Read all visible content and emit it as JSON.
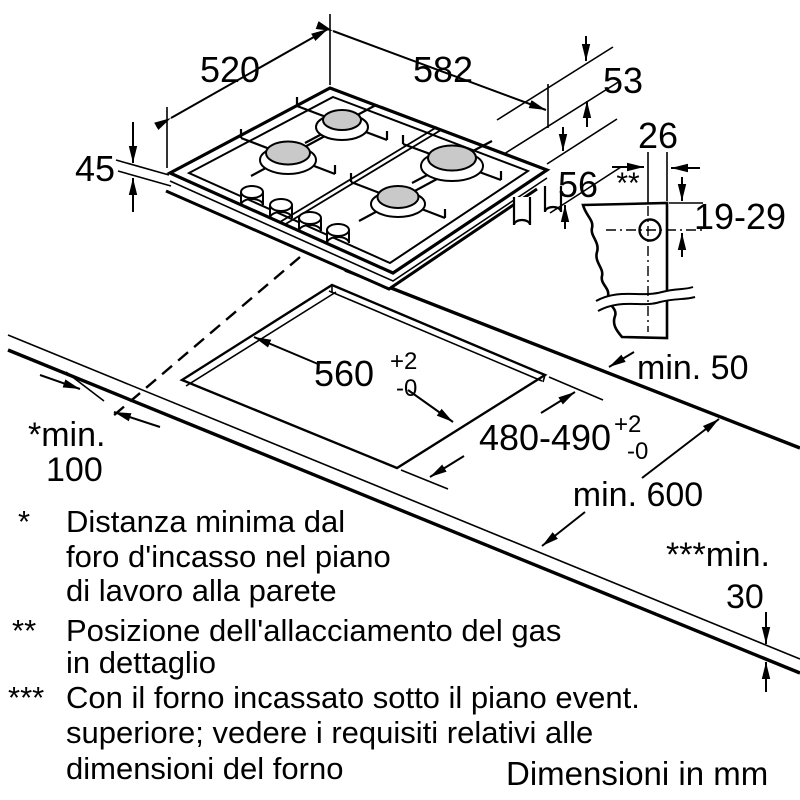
{
  "hob": {
    "width": "582",
    "depth": "520",
    "height_left": "45",
    "height_top_right": "53",
    "height_right": "56"
  },
  "gas_detail": {
    "marker": "**",
    "offset_from_edge": "26",
    "height_range": "19-29"
  },
  "cutout": {
    "width": "560",
    "depth": "480-490",
    "tol_plus": "+2",
    "tol_minus": "-0",
    "rear_clearance": "min. 50",
    "worktop_depth": "min. 600",
    "wall_clearance_line1": "*min.",
    "wall_clearance_line2": "100",
    "thickness_line1": "***min.",
    "thickness_line2": "30"
  },
  "footnotes": [
    {
      "marker": "*",
      "lines": [
        "Distanza minima dal",
        "foro d'incasso nel piano",
        "di lavoro alla parete"
      ]
    },
    {
      "marker": "**",
      "lines": [
        "Posizione dell'allacciamento del gas",
        "in dettaglio"
      ]
    },
    {
      "marker": "***",
      "lines": [
        "Con il forno incassato sotto il piano event.",
        "superiore; vedere i requisiti relativi alle",
        "dimensioni del forno"
      ]
    }
  ],
  "units_label": "Dimensioni in mm"
}
